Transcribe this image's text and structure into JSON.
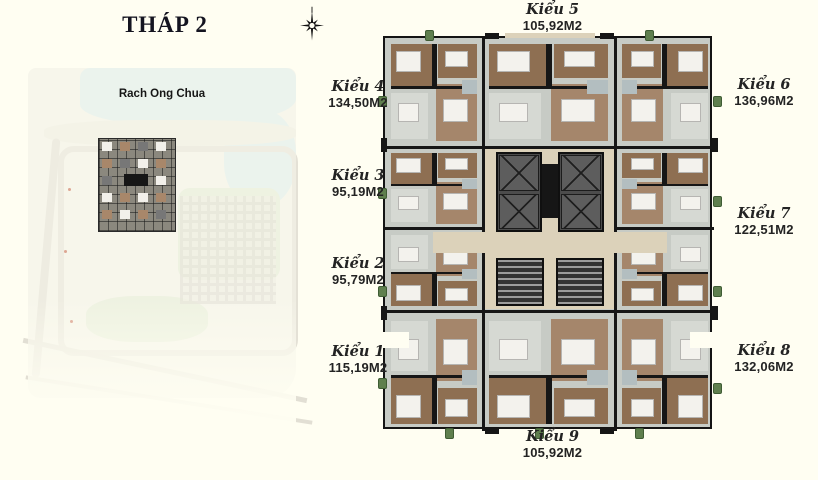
{
  "title": "THÁP 2",
  "compass": {
    "icon": "compass-rose"
  },
  "site_map": {
    "label": "Rach Ong Chua"
  },
  "floor_plan": {
    "units": [
      {
        "name": "Kiểu 1",
        "area": "115,19M2"
      },
      {
        "name": "Kiểu 2",
        "area": "95,79M2"
      },
      {
        "name": "Kiểu 3",
        "area": "95,19M2"
      },
      {
        "name": "Kiểu 4",
        "area": "134,50M2"
      },
      {
        "name": "Kiểu 5",
        "area": "105,92M2"
      },
      {
        "name": "Kiểu 6",
        "area": "136,96M2"
      },
      {
        "name": "Kiểu 7",
        "area": "122,51M2"
      },
      {
        "name": "Kiểu 8",
        "area": "132,06M2"
      },
      {
        "name": "Kiểu 9",
        "area": "105,92M2"
      }
    ]
  },
  "colors": {
    "background": "#fffef2",
    "title_text": "#141420",
    "label_text": "#232323",
    "plan_wall": "#141414",
    "plan_wood": "#8e6f52",
    "plan_tile": "#c7cbc5",
    "plan_corridor": "#dcd2ba",
    "map_water": "#dcebe9",
    "map_green": "#e2e8d4"
  }
}
